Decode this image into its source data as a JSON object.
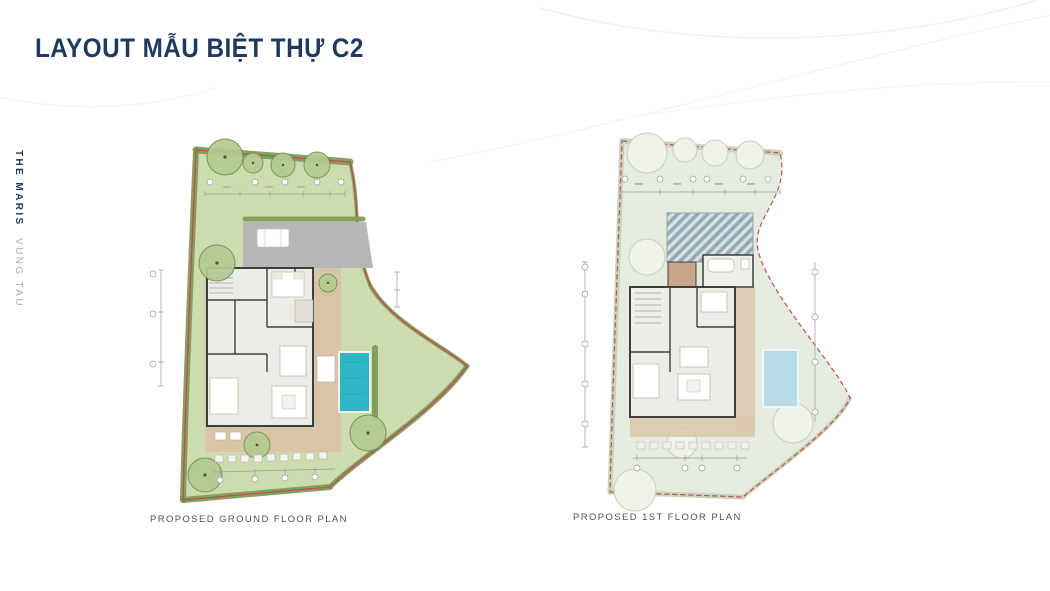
{
  "slide": {
    "title": "LAYOUT MẪU BIỆT THỰ C2",
    "brand": {
      "name": "THE MARIS",
      "location": "VUNG TAU"
    }
  },
  "plans": [
    {
      "id": "ground-floor",
      "caption": "PROPOSED GROUND FLOOR PLAN"
    },
    {
      "id": "first-floor",
      "caption": "PROPOSED 1ST FLOOR PLAN"
    }
  ],
  "colors": {
    "title_navy": "#1e3a5e",
    "caption_gray": "#4f4f4f",
    "lawn_green": "#cddcae",
    "hedge_green": "#7d9b5a",
    "boundary_red": "#c0504a",
    "pool_blue": "#2fb5c6",
    "faded_pool": "#b8dbe8",
    "faded_landscape": "#e6ebdf",
    "roof_hatch": "#a9bcc3",
    "deck_tan": "#d9c5a6",
    "driveway_gray": "#b7b7b5"
  }
}
